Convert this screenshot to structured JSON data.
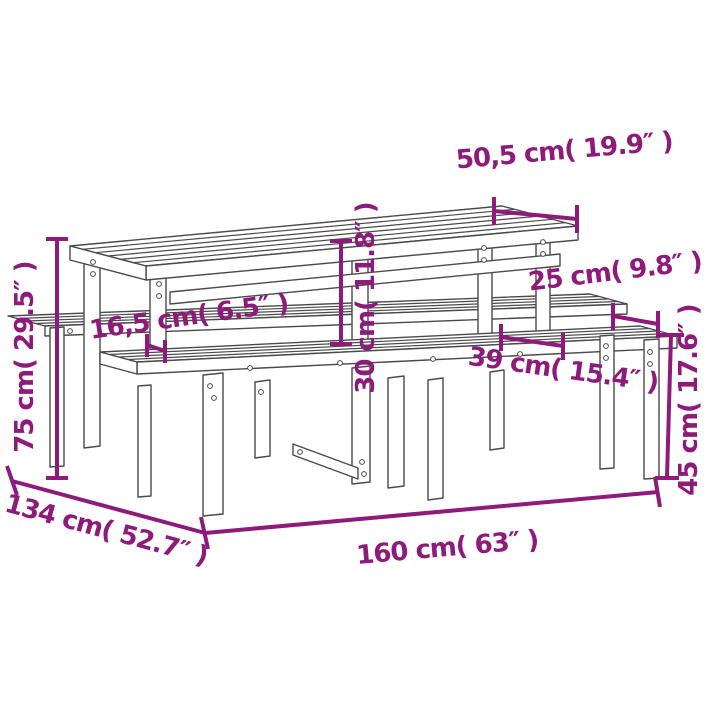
{
  "colors": {
    "annotation": "#8E1B7C",
    "furniture_outline": "#4a4a4a",
    "background": "#FFFFFF"
  },
  "annotations": {
    "tabletop_depth": {
      "label": "50,5 cm( 19.9″ )"
    },
    "bench_seat_depth": {
      "label": "25 cm( 9.8″ )"
    },
    "leg_to_bench_gap": {
      "label": "16,5 cm( 6.5″ )"
    },
    "table_bench_rise": {
      "label": "30 cm( 11.8″ )"
    },
    "bench_offset": {
      "label": "39 cm( 15.4″ )"
    },
    "table_height": {
      "label": "75 cm( 29.5″ )"
    },
    "bench_height": {
      "label": "45 cm( 17.6″ )"
    },
    "set_depth": {
      "label": "134 cm( 52.7″ )"
    },
    "set_length": {
      "label": "160 cm( 63″ )"
    }
  }
}
